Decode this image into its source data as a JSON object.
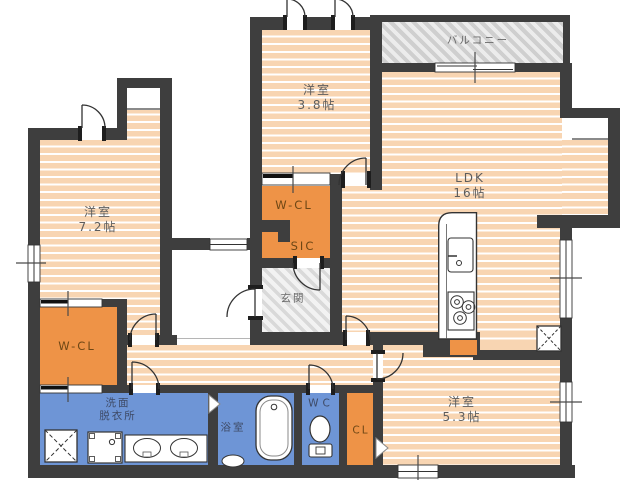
{
  "plan_type": "floor-plan",
  "colors": {
    "wall": "#3e3e3e",
    "floor": "#f8d5b2",
    "closet": "#ee9347",
    "wet": "#6e95d6",
    "hatch_balcony": "#cfcfcf",
    "hatch_genkan": "#d9d9d9"
  },
  "rooms": {
    "balcony": {
      "label": "バルコニー"
    },
    "bedroom_38": {
      "label": "洋室",
      "area": "3.8帖"
    },
    "ldk": {
      "label": "LDK",
      "area": "16帖"
    },
    "bedroom_72": {
      "label": "洋室",
      "area": "7.2帖"
    },
    "bedroom_53": {
      "label": "洋室",
      "area": "5.3帖"
    },
    "wcl_top": {
      "label": "W-CL"
    },
    "sic": {
      "label": "SIC"
    },
    "genkan": {
      "label": "玄関"
    },
    "wcl_left": {
      "label": "W-CL"
    },
    "senmen": {
      "label_line1": "洗面",
      "label_line2": "脱衣所"
    },
    "bath": {
      "label": "浴室"
    },
    "wc": {
      "label": "WC"
    },
    "cl": {
      "label": "CL"
    }
  }
}
